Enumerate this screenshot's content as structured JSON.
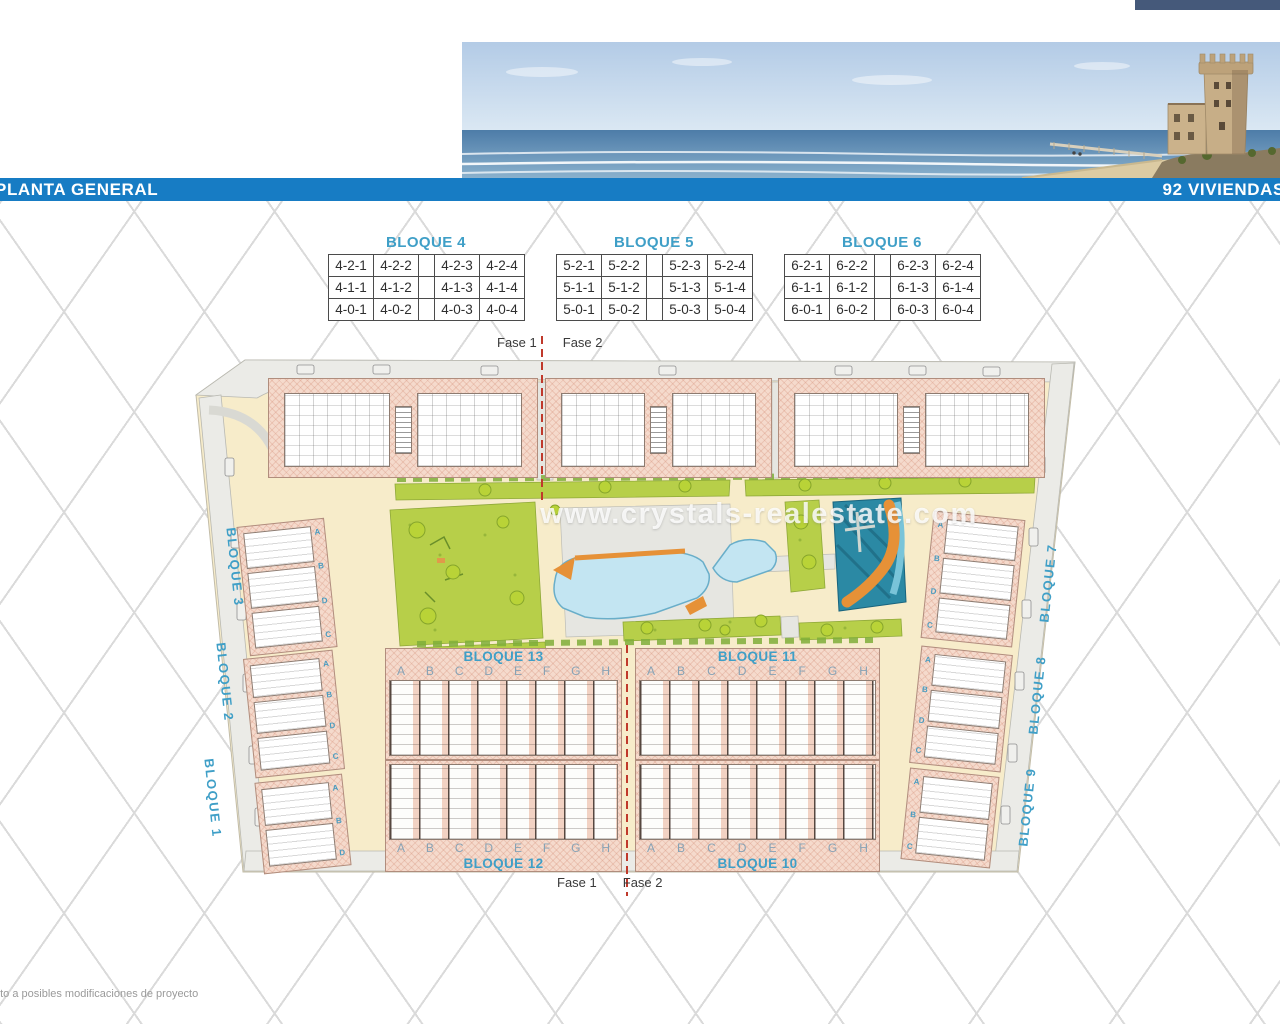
{
  "header": {
    "title": "PLANTA GENERAL",
    "right_label": "92 VIVIENDAS"
  },
  "unit_tables": [
    {
      "title": "BLOQUE 4",
      "rows": [
        [
          "4-2-1",
          "4-2-2",
          "4-2-3",
          "4-2-4"
        ],
        [
          "4-1-1",
          "4-1-2",
          "4-1-3",
          "4-1-4"
        ],
        [
          "4-0-1",
          "4-0-2",
          "4-0-3",
          "4-0-4"
        ]
      ]
    },
    {
      "title": "BLOQUE 5",
      "rows": [
        [
          "5-2-1",
          "5-2-2",
          "5-2-3",
          "5-2-4"
        ],
        [
          "5-1-1",
          "5-1-2",
          "5-1-3",
          "5-1-4"
        ],
        [
          "5-0-1",
          "5-0-2",
          "5-0-3",
          "5-0-4"
        ]
      ]
    },
    {
      "title": "BLOQUE 6",
      "rows": [
        [
          "6-2-1",
          "6-2-2",
          "6-2-3",
          "6-2-4"
        ],
        [
          "6-1-1",
          "6-1-2",
          "6-1-3",
          "6-1-4"
        ],
        [
          "6-0-1",
          "6-0-2",
          "6-0-3",
          "6-0-4"
        ]
      ]
    }
  ],
  "plan": {
    "watermark": "www.crystals-realestate.com",
    "phase": {
      "fase1": "Fase 1",
      "fase2": "Fase 2"
    },
    "row_letters": [
      "A",
      "B",
      "C",
      "D",
      "E",
      "F",
      "G",
      "H"
    ],
    "cluster_letters": [
      "A",
      "B",
      "C",
      "D"
    ],
    "center_blocks": {
      "top_left": "BLOQUE 13",
      "top_right": "BLOQUE 11",
      "bottom_left": "BLOQUE 12",
      "bottom_right": "BLOQUE 10"
    },
    "left_blocks": [
      "BLOQUE 3",
      "BLOQUE 2",
      "BLOQUE 1"
    ],
    "right_blocks": [
      "BLOQUE 7",
      "BLOQUE 8",
      "BLOQUE 9"
    ]
  },
  "footer": {
    "note": "eto a posibles modificaciones de proyecto"
  },
  "colors": {
    "titlebar_blue": "#177cc4",
    "block_label_blue": "#3f9fc7",
    "phase_line_red": "#c0392b",
    "pool_blue": "#c3e5f2",
    "lagoon_teal": "#2b89a4",
    "accent_orange": "#e69137",
    "plan_cream": "#f7ecca",
    "building_pink": "#f5dacc"
  }
}
